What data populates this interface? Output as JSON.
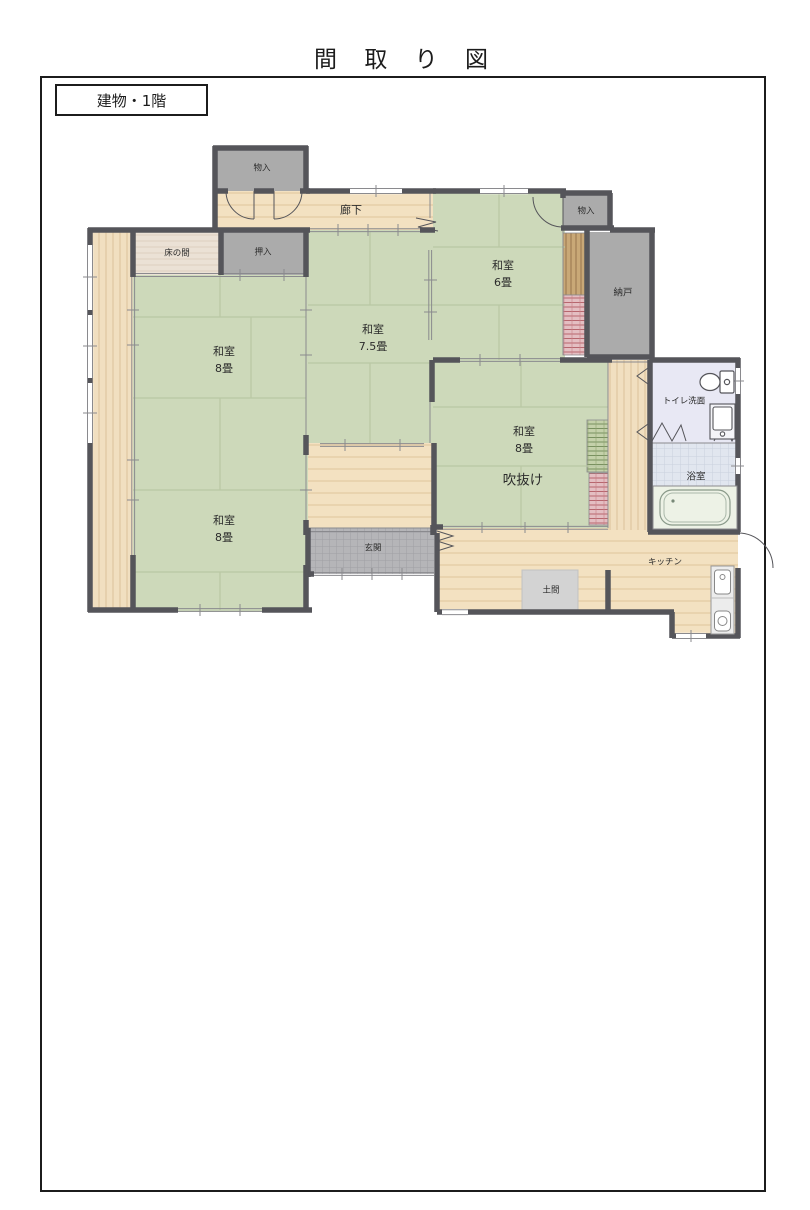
{
  "page": {
    "title": "間 取 り 図",
    "floor_tag": "建物・1階"
  },
  "rooms": {
    "corridor": {
      "label": "廊下"
    },
    "storage_top": {
      "label": "物入"
    },
    "tokonoma": {
      "label": "床の間"
    },
    "oshiire": {
      "label": "押入"
    },
    "washitsu_nw": {
      "label": "和室",
      "size": "8畳"
    },
    "washitsu_center": {
      "label": "和室",
      "size": "7.5畳"
    },
    "washitsu_ne": {
      "label": "和室",
      "size": "6畳"
    },
    "storage_right": {
      "label": "物入"
    },
    "nando": {
      "label": "納戸"
    },
    "toilet": {
      "label": "トイレ洗面"
    },
    "washitsu_e": {
      "label": "和室",
      "size": "8畳"
    },
    "atrium": {
      "label": "吹抜け"
    },
    "bath": {
      "label": "浴室"
    },
    "washitsu_sw": {
      "label": "和室",
      "size": "8畳"
    },
    "genkan": {
      "label": "玄関"
    },
    "doma": {
      "label": "土間"
    },
    "kitchen": {
      "label": "キッチン"
    }
  },
  "colors": {
    "wall": "#55555a",
    "tatami": "#cdd9ba",
    "tatami_line": "#b9c8a4",
    "wood_floor": "#f3e1c1",
    "wood_line": "#dfc59c",
    "tokonoma_wood": "#ebe1d5",
    "closet_gray": "#ababab",
    "genkan_tile": "#b5b5b8",
    "doma_gray": "#d3d3d3",
    "toilet_floor": "#e8e8f4",
    "bath_tile": "#e1e6ef",
    "stair_wood": "#c9a877",
    "stair_pink": "#e4bec2",
    "stair_green": "#c4d1aa",
    "tub_fill": "#edf2e6"
  }
}
